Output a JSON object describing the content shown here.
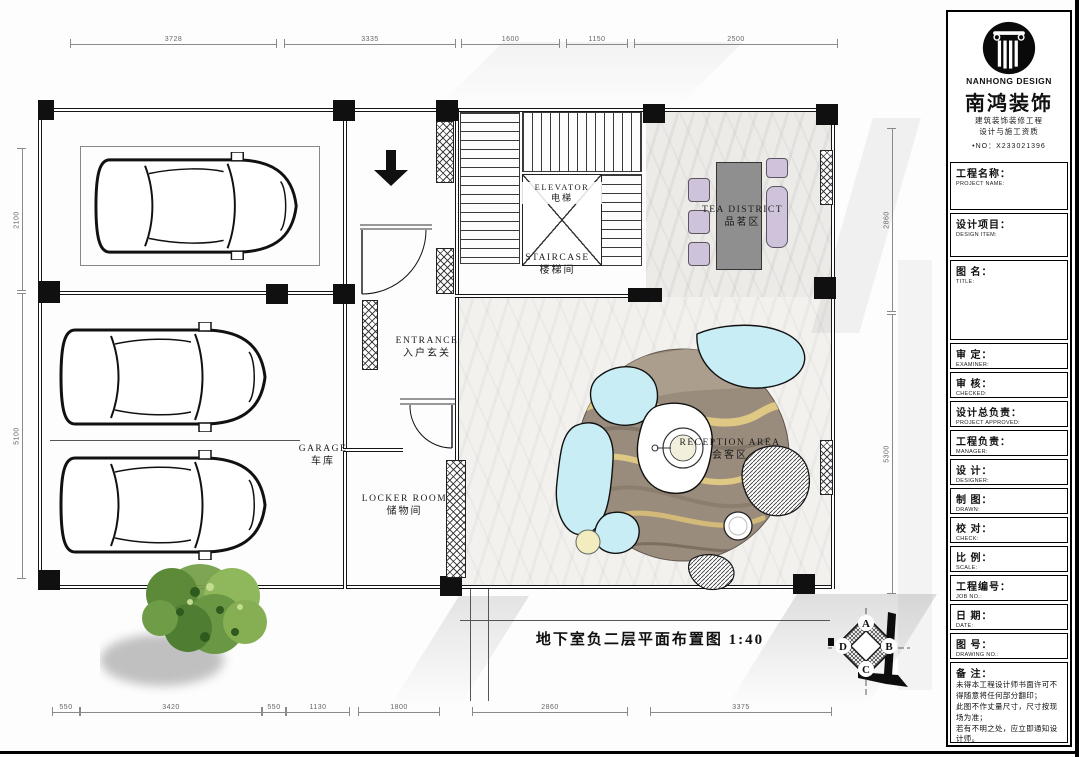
{
  "plan": {
    "title": "地下室负二层平面布置图 1:40",
    "rooms": {
      "elevator": {
        "en": "ELEVATOR",
        "cn": "电梯"
      },
      "staircase": {
        "en": "STAIRCASE",
        "cn": "楼梯间"
      },
      "tea": {
        "en": "TEA  DISTRICT",
        "cn": "品茗区"
      },
      "entrance": {
        "en": "ENTRANCE",
        "cn": "入户玄关"
      },
      "garage": {
        "en": "GARAGE",
        "cn": "车库"
      },
      "locker": {
        "en": "LOCKER  ROOM",
        "cn": "储物间"
      },
      "reception": {
        "en": "RECEPTION  AREA",
        "cn": "会客区"
      }
    }
  },
  "dimensions": {
    "top": [
      "3728",
      "3335",
      "1600",
      "1150",
      "2500"
    ],
    "bottom": [
      "550",
      "3420",
      "550",
      "1130",
      "1800",
      "2860",
      "3375"
    ],
    "left": [
      "2100",
      "5100"
    ],
    "right": [
      "2860",
      "5300"
    ]
  },
  "marker": {
    "a": "A",
    "b": "B",
    "c": "C",
    "d": "D"
  },
  "title_block": {
    "brand": {
      "en": "NANHONG DESIGN",
      "cn": "南鸿装饰",
      "cert1": "建筑装饰装修工程",
      "cert2": "设计与施工资质",
      "cert_no": "•NO：X233021396"
    },
    "fields": [
      {
        "cn": "工程名称：",
        "en": "PROJECT NAME:"
      },
      {
        "cn": "设计项目：",
        "en": "DESIGN ITEM:"
      },
      {
        "cn": "图  名：",
        "en": "TITLE:"
      },
      {
        "cn": "审  定：",
        "en": "EXAMINER:"
      },
      {
        "cn": "审  核：",
        "en": "CHECKED:"
      },
      {
        "cn": "设计总负责：",
        "en": "PROJECT APPROVED:"
      },
      {
        "cn": "工程负责：",
        "en": "MANAGER:"
      },
      {
        "cn": "设  计：",
        "en": "DESIGNER:"
      },
      {
        "cn": "制  图：",
        "en": "DRAWN:"
      },
      {
        "cn": "校  对：",
        "en": "CHECK:"
      },
      {
        "cn": "比  例：",
        "en": "SCALE:"
      },
      {
        "cn": "工程编号：",
        "en": "JOB NO.:"
      },
      {
        "cn": "日  期：",
        "en": "DATE:"
      },
      {
        "cn": "图  号：",
        "en": "DRAWING NO.:"
      }
    ],
    "notes": {
      "label": "备  注：",
      "lines": [
        "未得本工程设计师书面许可不得随意将任何部分翻印；",
        "此图不作丈量尺寸，尺寸按现场为准；",
        "若有不明之处，应立即通知设计师。"
      ],
      "fine_print": "本设计解释权归设计师所有。",
      "hotline": "免费咨询电话：400 8383 168"
    }
  },
  "colors": {
    "wall": "#151515",
    "rug": "#9a8c7d",
    "rug_wave": "#dfc784",
    "sofa_cyan": "#c8edf4",
    "chair_lavender": "#cfc3dc",
    "table_grey": "#8f8f8f",
    "tree_green": "#76a04a"
  }
}
